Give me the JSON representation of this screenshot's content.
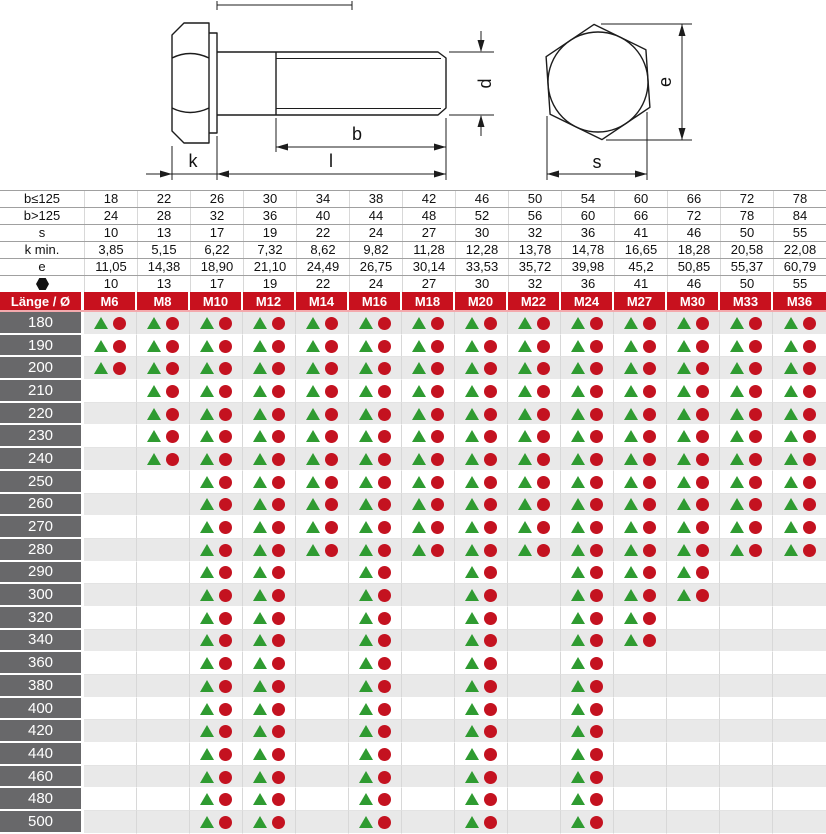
{
  "drawing": {
    "labels": {
      "k": "k",
      "l": "l",
      "b": "b",
      "d": "d",
      "e": "e",
      "s": "s"
    }
  },
  "dimensions": {
    "rows": [
      {
        "label": "b≤125",
        "values": [
          "18",
          "22",
          "26",
          "30",
          "34",
          "38",
          "42",
          "46",
          "50",
          "54",
          "60",
          "66",
          "72",
          "78"
        ]
      },
      {
        "label": "b>125",
        "values": [
          "24",
          "28",
          "32",
          "36",
          "40",
          "44",
          "48",
          "52",
          "56",
          "60",
          "66",
          "72",
          "78",
          "84"
        ]
      },
      {
        "label": "s",
        "values": [
          "10",
          "13",
          "17",
          "19",
          "22",
          "24",
          "27",
          "30",
          "32",
          "36",
          "41",
          "46",
          "50",
          "55"
        ]
      },
      {
        "label": "k min.",
        "values": [
          "3,85",
          "5,15",
          "6,22",
          "7,32",
          "8,62",
          "9,82",
          "11,28",
          "12,28",
          "13,78",
          "14,78",
          "16,65",
          "18,28",
          "20,58",
          "22,08"
        ]
      },
      {
        "label": "e",
        "values": [
          "11,05",
          "14,38",
          "18,90",
          "21,10",
          "24,49",
          "26,75",
          "30,14",
          "33,53",
          "35,72",
          "39,98",
          "45,2",
          "50,85",
          "55,37",
          "60,79"
        ]
      },
      {
        "label": "",
        "icon": "hexagon",
        "values": [
          "10",
          "13",
          "17",
          "19",
          "22",
          "24",
          "27",
          "30",
          "32",
          "36",
          "41",
          "46",
          "50",
          "55"
        ]
      }
    ]
  },
  "matrix": {
    "corner_label": "Länge / Ø",
    "columns": [
      "M6",
      "M8",
      "M10",
      "M12",
      "M14",
      "M16",
      "M18",
      "M20",
      "M22",
      "M24",
      "M27",
      "M30",
      "M33",
      "M36"
    ],
    "legend": {
      "triangle_color": "#2f9b31",
      "circle_color": "#c41220"
    },
    "rows": [
      {
        "length": "180",
        "available": [
          1,
          1,
          1,
          1,
          1,
          1,
          1,
          1,
          1,
          1,
          1,
          1,
          1,
          1
        ]
      },
      {
        "length": "190",
        "available": [
          1,
          1,
          1,
          1,
          1,
          1,
          1,
          1,
          1,
          1,
          1,
          1,
          1,
          1
        ]
      },
      {
        "length": "200",
        "available": [
          1,
          1,
          1,
          1,
          1,
          1,
          1,
          1,
          1,
          1,
          1,
          1,
          1,
          1
        ]
      },
      {
        "length": "210",
        "available": [
          0,
          1,
          1,
          1,
          1,
          1,
          1,
          1,
          1,
          1,
          1,
          1,
          1,
          1
        ]
      },
      {
        "length": "220",
        "available": [
          0,
          1,
          1,
          1,
          1,
          1,
          1,
          1,
          1,
          1,
          1,
          1,
          1,
          1
        ]
      },
      {
        "length": "230",
        "available": [
          0,
          1,
          1,
          1,
          1,
          1,
          1,
          1,
          1,
          1,
          1,
          1,
          1,
          1
        ]
      },
      {
        "length": "240",
        "available": [
          0,
          1,
          1,
          1,
          1,
          1,
          1,
          1,
          1,
          1,
          1,
          1,
          1,
          1
        ]
      },
      {
        "length": "250",
        "available": [
          0,
          0,
          1,
          1,
          1,
          1,
          1,
          1,
          1,
          1,
          1,
          1,
          1,
          1
        ]
      },
      {
        "length": "260",
        "available": [
          0,
          0,
          1,
          1,
          1,
          1,
          1,
          1,
          1,
          1,
          1,
          1,
          1,
          1
        ]
      },
      {
        "length": "270",
        "available": [
          0,
          0,
          1,
          1,
          1,
          1,
          1,
          1,
          1,
          1,
          1,
          1,
          1,
          1
        ]
      },
      {
        "length": "280",
        "available": [
          0,
          0,
          1,
          1,
          1,
          1,
          1,
          1,
          1,
          1,
          1,
          1,
          1,
          1
        ]
      },
      {
        "length": "290",
        "available": [
          0,
          0,
          1,
          1,
          0,
          1,
          0,
          1,
          0,
          1,
          1,
          1,
          0,
          0
        ]
      },
      {
        "length": "300",
        "available": [
          0,
          0,
          1,
          1,
          0,
          1,
          0,
          1,
          0,
          1,
          1,
          1,
          0,
          0
        ]
      },
      {
        "length": "320",
        "available": [
          0,
          0,
          1,
          1,
          0,
          1,
          0,
          1,
          0,
          1,
          1,
          0,
          0,
          0
        ]
      },
      {
        "length": "340",
        "available": [
          0,
          0,
          1,
          1,
          0,
          1,
          0,
          1,
          0,
          1,
          1,
          0,
          0,
          0
        ]
      },
      {
        "length": "360",
        "available": [
          0,
          0,
          1,
          1,
          0,
          1,
          0,
          1,
          0,
          1,
          0,
          0,
          0,
          0
        ]
      },
      {
        "length": "380",
        "available": [
          0,
          0,
          1,
          1,
          0,
          1,
          0,
          1,
          0,
          1,
          0,
          0,
          0,
          0
        ]
      },
      {
        "length": "400",
        "available": [
          0,
          0,
          1,
          1,
          0,
          1,
          0,
          1,
          0,
          1,
          0,
          0,
          0,
          0
        ]
      },
      {
        "length": "420",
        "available": [
          0,
          0,
          1,
          1,
          0,
          1,
          0,
          1,
          0,
          1,
          0,
          0,
          0,
          0
        ]
      },
      {
        "length": "440",
        "available": [
          0,
          0,
          1,
          1,
          0,
          1,
          0,
          1,
          0,
          1,
          0,
          0,
          0,
          0
        ]
      },
      {
        "length": "460",
        "available": [
          0,
          0,
          1,
          1,
          0,
          1,
          0,
          1,
          0,
          1,
          0,
          0,
          0,
          0
        ]
      },
      {
        "length": "480",
        "available": [
          0,
          0,
          1,
          1,
          0,
          1,
          0,
          1,
          0,
          1,
          0,
          0,
          0,
          0
        ]
      },
      {
        "length": "500",
        "available": [
          0,
          0,
          1,
          1,
          0,
          1,
          0,
          1,
          0,
          1,
          0,
          0,
          0,
          0
        ]
      }
    ]
  },
  "colors": {
    "header_red": "#c8111e",
    "header_divider_pink": "#f4a9ad",
    "length_cell_gray": "#68686a",
    "row_alt_gray": "#e9e9e9",
    "marker_green": "#2f9b31",
    "marker_red": "#c41220",
    "grid_light": "#d8d8d8",
    "grid_dark": "#a0a0a0",
    "drawing_line": "#1c1c1c"
  }
}
